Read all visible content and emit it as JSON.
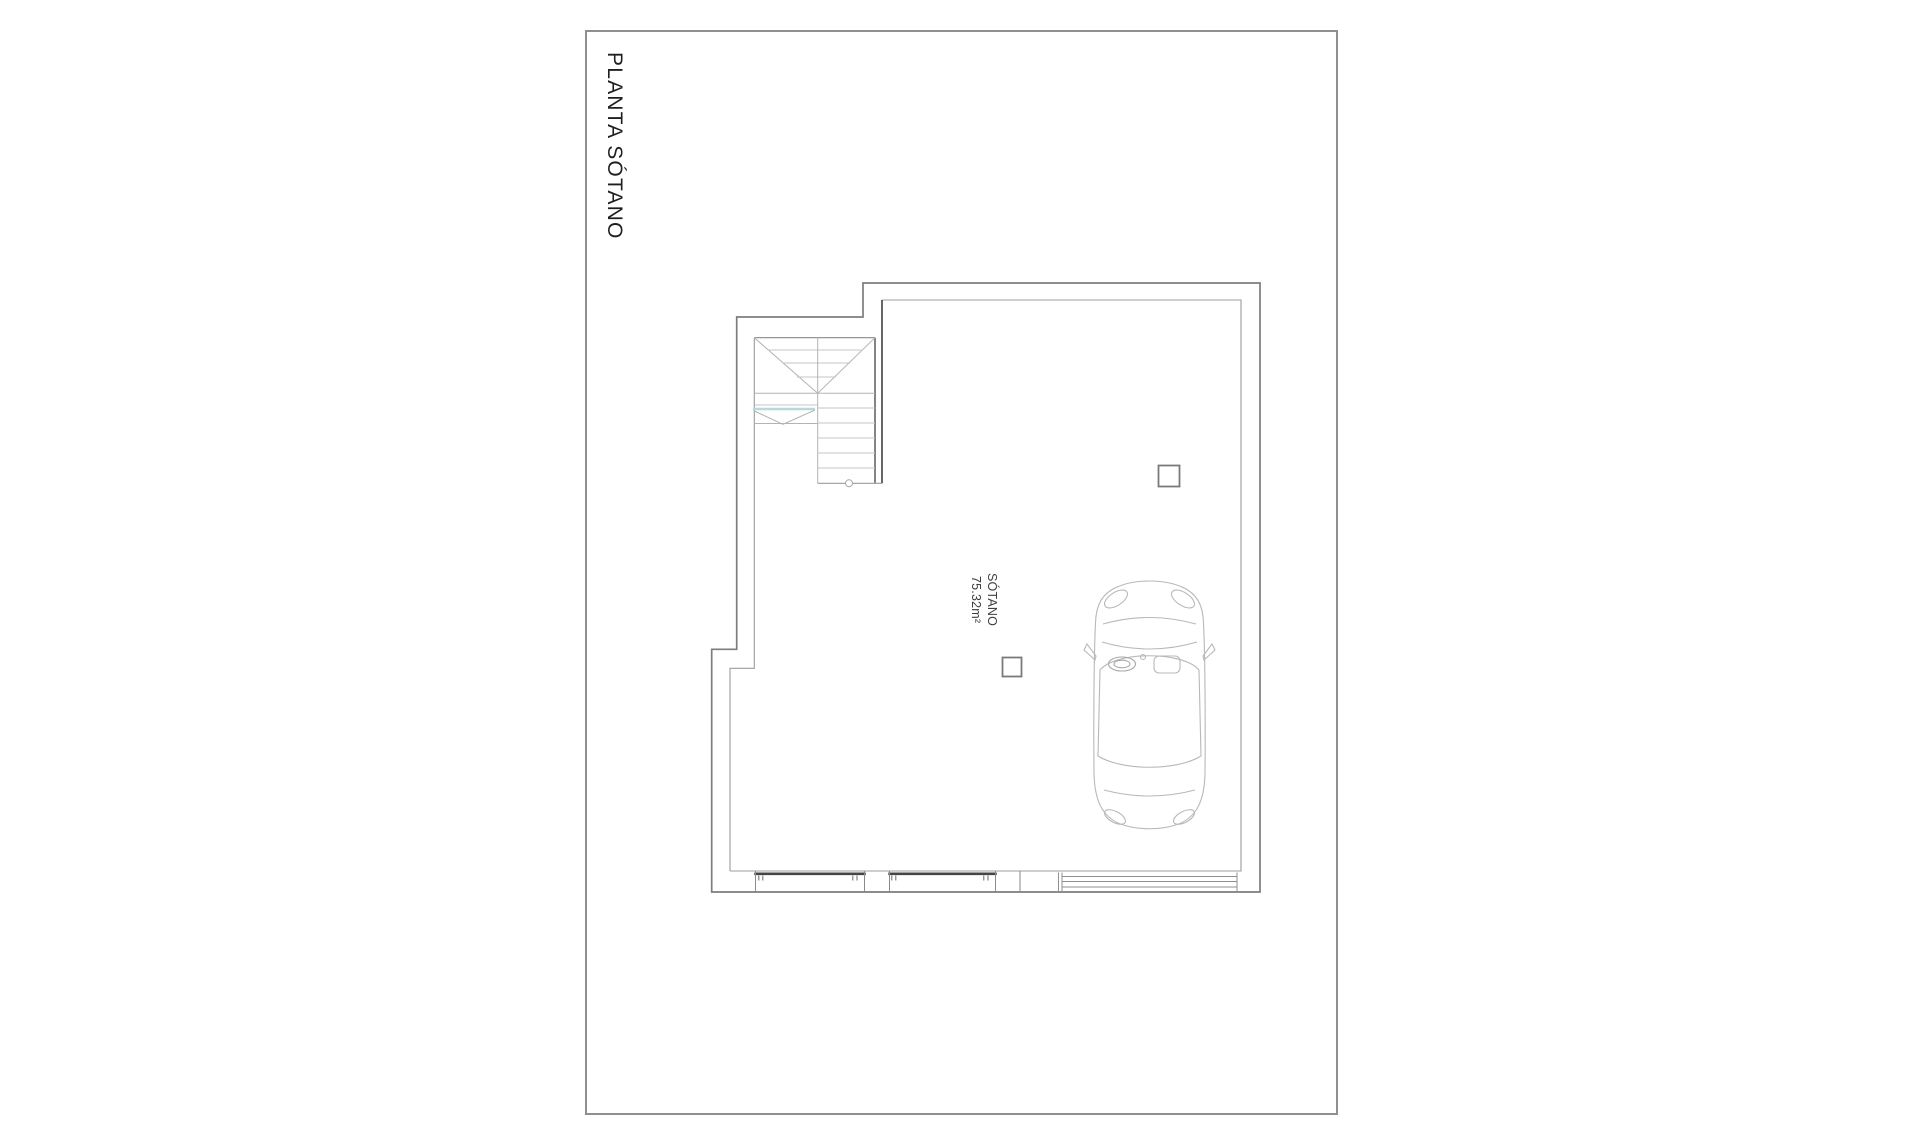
{
  "page": {
    "background": "#ffffff",
    "border_color": "#8f8f8f",
    "title": "PLANTA SÓTANO"
  },
  "plan": {
    "room_label": {
      "name": "SÓTANO",
      "area": "75.32m²"
    },
    "elements": [
      "staircase",
      "car-top-view",
      "column-marker",
      "column-marker",
      "window-unit",
      "window-unit",
      "garage-door"
    ],
    "colors": {
      "walls": "#828282",
      "inner_lines": "#9c9c9c",
      "stair_lines": "#c4c4c4",
      "stair_diagonals": "#b3b3b3",
      "stair_accent": "#b7d8dc",
      "window_lintel": "#454545",
      "car_outline": "#b8b8b8"
    }
  }
}
